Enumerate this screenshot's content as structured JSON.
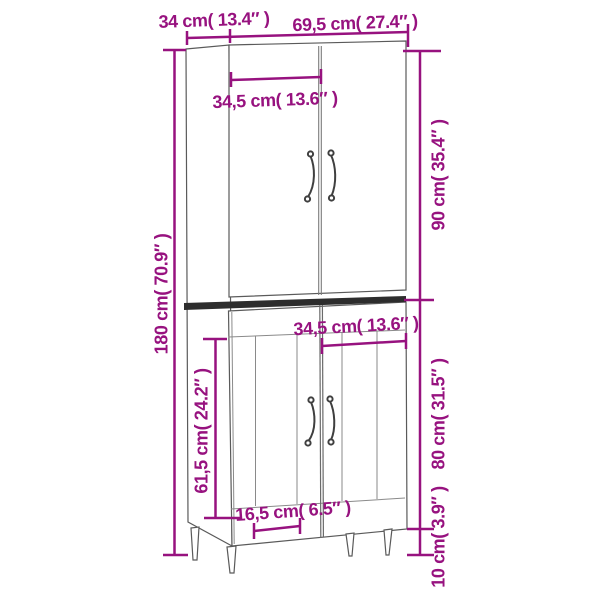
{
  "diagram": {
    "type": "furniture-dimension-diagram",
    "subject": "tall highboard cabinet with four doors and tapered legs",
    "background": "#ffffff",
    "colors": {
      "dimension_accent": "#97127F",
      "cabinet_outline": "#5a5a5a",
      "cabinet_detail_line": "#8a8a8a",
      "divider_band": "#2d2d2d",
      "cabinet_fill": "#ffffff"
    }
  },
  "measurements": {
    "depth": {
      "label": "34 cm( 13.4″ )",
      "cm": 34,
      "inches": 13.4,
      "orientation": "horizontal",
      "position": "top-left"
    },
    "width": {
      "label": "69,5 cm( 27.4″ )",
      "cm": 69.5,
      "inches": 27.4,
      "orientation": "horizontal",
      "position": "top-right"
    },
    "upper_door_width": {
      "label": "34,5 cm( 13.6″ )",
      "cm": 34.5,
      "inches": 13.6,
      "orientation": "horizontal",
      "position": "upper-front"
    },
    "total_height": {
      "label": "180 cm( 70.9″ )",
      "cm": 180,
      "inches": 70.9,
      "orientation": "vertical",
      "position": "left"
    },
    "upper_section_height": {
      "label": "90 cm( 35.4″ )",
      "cm": 90,
      "inches": 35.4,
      "orientation": "vertical",
      "position": "right-upper"
    },
    "lower_door_width": {
      "label": "34,5 cm( 13.6″ )",
      "cm": 34.5,
      "inches": 13.6,
      "orientation": "horizontal",
      "position": "middle-front"
    },
    "lower_door_height": {
      "label": "61,5 cm( 24.2″ )",
      "cm": 61.5,
      "inches": 24.2,
      "orientation": "vertical",
      "position": "lower-left"
    },
    "lower_section_height": {
      "label": "80 cm( 31.5″ )",
      "cm": 80,
      "inches": 31.5,
      "orientation": "vertical",
      "position": "right-lower"
    },
    "leg_inset": {
      "label": "16,5 cm( 6.5″ )",
      "cm": 16.5,
      "inches": 6.5,
      "orientation": "horizontal",
      "position": "bottom"
    },
    "leg_height": {
      "label": "10 cm( 3.9″ )",
      "cm": 10,
      "inches": 3.9,
      "orientation": "vertical",
      "position": "bottom-right"
    }
  }
}
